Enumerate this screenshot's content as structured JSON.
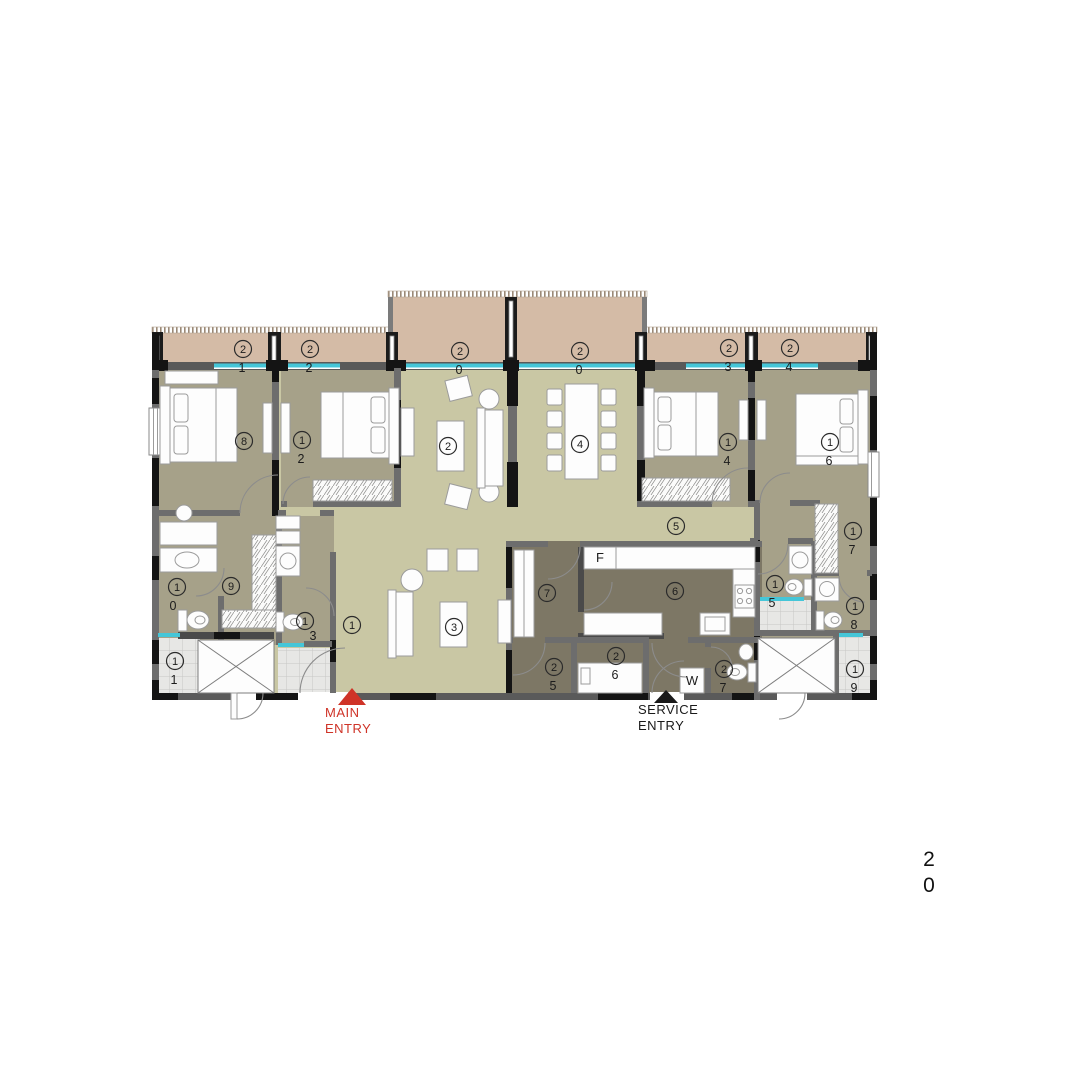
{
  "plan_colors": {
    "balcony": "#d4bba6",
    "living_floor": "#c9c7a4",
    "bedroom_floor": "#a6a189",
    "kitchen_floor": "#7d7765",
    "tile_floor": "#e7e7e5",
    "sliding_door_cyan": "#45c6d8",
    "wall_gray": "#6d6d6d",
    "column_black": "#141414",
    "entry_red": "#cf3327"
  },
  "labels": {
    "b21": {
      "circle": "2",
      "sub": "1"
    },
    "b22": {
      "circle": "2",
      "sub": "2"
    },
    "b20l": {
      "circle": "2",
      "sub": "0"
    },
    "b20r": {
      "circle": "2",
      "sub": "0"
    },
    "b23": {
      "circle": "2",
      "sub": "3"
    },
    "b24": {
      "circle": "2",
      "sub": "4"
    },
    "r8": {
      "circle": "8",
      "sub": ""
    },
    "r12": {
      "circle": "1",
      "sub": "2"
    },
    "r2": {
      "circle": "2",
      "sub": ""
    },
    "r4": {
      "circle": "4",
      "sub": ""
    },
    "r14": {
      "circle": "1",
      "sub": "4"
    },
    "r16": {
      "circle": "1",
      "sub": "6"
    },
    "r5": {
      "circle": "5",
      "sub": ""
    },
    "r10": {
      "circle": "1",
      "sub": "0"
    },
    "r9": {
      "circle": "9",
      "sub": ""
    },
    "r13": {
      "circle": "1",
      "sub": "3"
    },
    "r1": {
      "circle": "1",
      "sub": ""
    },
    "r3": {
      "circle": "3",
      "sub": ""
    },
    "r7": {
      "circle": "7",
      "sub": ""
    },
    "r6": {
      "circle": "6",
      "sub": ""
    },
    "r25": {
      "circle": "2",
      "sub": "5"
    },
    "r26": {
      "circle": "2",
      "sub": "6"
    },
    "r27": {
      "circle": "2",
      "sub": "7"
    },
    "r15": {
      "circle": "1",
      "sub": "5"
    },
    "r17": {
      "circle": "1",
      "sub": "7"
    },
    "r18": {
      "circle": "1",
      "sub": "8"
    },
    "r19": {
      "circle": "1",
      "sub": "9"
    },
    "r11": {
      "circle": "1",
      "sub": "1"
    }
  },
  "appliances": {
    "fridge": "F",
    "washer": "W"
  },
  "entries": {
    "main": {
      "line1": "MAIN",
      "line2": "ENTRY"
    },
    "service": {
      "line1": "SERVICE",
      "line2": "ENTRY"
    }
  },
  "page_number": {
    "line1": "2",
    "line2": "0"
  }
}
